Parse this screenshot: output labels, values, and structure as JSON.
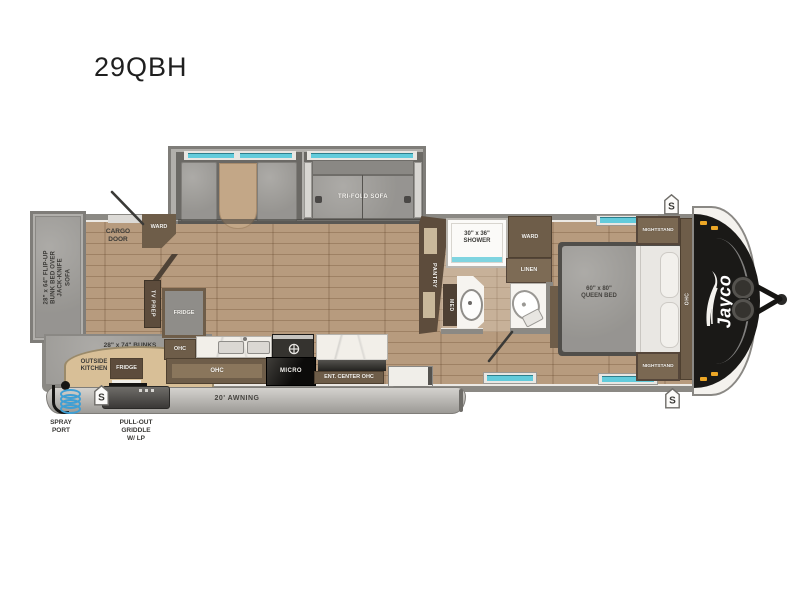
{
  "title": "29QBH",
  "colors": {
    "accent_teal": "#62cbdb",
    "wood_floor": "#b79b7e",
    "cabinet_brown": "#6e5d49",
    "front_cap_black": "#171614",
    "cushion_gray": "#a3a19d",
    "outside_kitchen_tan": "#d8bf97"
  },
  "floorplan": {
    "brand": "Jayco",
    "speaker_marker": "S",
    "exterior": {
      "awning": "20' AWNING",
      "spray_port": "SPRAY\nPORT",
      "griddle": "PULL-OUT\nGRIDDLE\nW/ LP",
      "cargo_door": "CARGO\nDOOR",
      "outside_kitchen": "OUTSIDE\nKITCHEN",
      "outside_fridge": "FRIDGE"
    },
    "living": {
      "tri_fold_sofa": "TRI-FOLD SOFA",
      "flip_up_bunk": "28\" x 64\" FLIP-UP\nBUNK BED OVER\nJACK-KNIFE SOFA",
      "bunks": "28\" x 74\" BUNKS",
      "ward": "WARD",
      "tv_prep": "TV PREP"
    },
    "kitchen": {
      "fridge": "FRIDGE",
      "ohc_upper": "OHC",
      "ohc_lower": "OHC",
      "micro": "MICRO",
      "ent_center": "ENT. CENTER OHC",
      "pantry": "PANTRY"
    },
    "bath": {
      "shower": "30\" x 36\"\nSHOWER",
      "ward": "WARD",
      "linen": "LINEN",
      "med": "MED"
    },
    "bedroom": {
      "queen_bed": "60\" x 80\"\nQUEEN BED",
      "nightstand_top": "NIGHTSTAND",
      "nightstand_bottom": "NIGHTSTAND",
      "ohc": "OHC"
    }
  }
}
